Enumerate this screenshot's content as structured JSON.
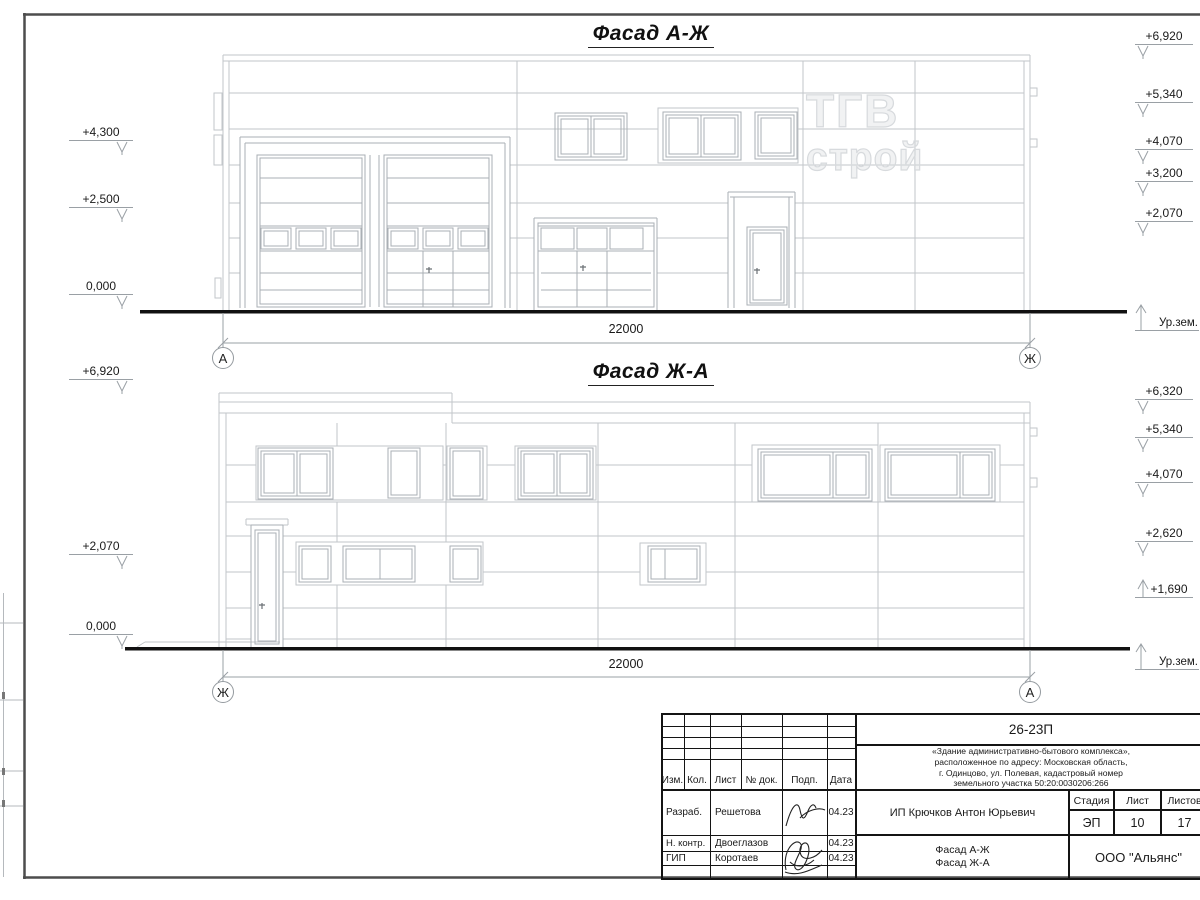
{
  "facade_top": {
    "title": "Фасад А-Ж",
    "dimension": "22000",
    "axis_left": "А",
    "axis_right": "Ж",
    "ground_label": "Ур.зем.",
    "marks_left": [
      "+4,300",
      "+2,500",
      "0,000"
    ],
    "marks_right": [
      "+6,920",
      "+5,340",
      "+4,070",
      "+3,200",
      "+2,070"
    ],
    "watermark": [
      "ТГВ",
      "строй"
    ]
  },
  "facade_bottom": {
    "title": "Фасад Ж-А",
    "dimension": "22000",
    "axis_left": "Ж",
    "axis_right": "А",
    "ground_label": "Ур.зем.",
    "marks_left": [
      "+6,920",
      "+2,070",
      "0,000"
    ],
    "marks_right": [
      "+6,320",
      "+5,340",
      "+4,070",
      "+2,620",
      "+1,690"
    ]
  },
  "title_block": {
    "doc_number": "26-23П",
    "description_lines": [
      "«Здание административно-бытового комплекса»,",
      "расположенное по адресу: Московская область,",
      "г. Одинцово, ул. Полевая, кадастровый номер",
      "земельного участка 50:20:0030206:266"
    ],
    "columns": [
      "Изм.",
      "Кол.",
      "Лист",
      "№ док.",
      "Подп.",
      "Дата"
    ],
    "signers": [
      {
        "role": "Разраб.",
        "name": "Решетова",
        "date": "04.23"
      },
      {
        "role": "Н. контр.",
        "name": "Двоеглазов",
        "date": "04.23"
      },
      {
        "role": "ГИП",
        "name": "Коротаев",
        "date": "04.23"
      }
    ],
    "client": "ИП Крючков Антон Юрьевич",
    "stage_label": "Стадия",
    "sheet_label": "Лист",
    "sheets_label": "Листов",
    "stage": "ЭП",
    "sheet_number": "10",
    "sheets_total": "17",
    "drawing_names": [
      "Фасад А-Ж",
      "Фасад Ж-А"
    ],
    "company": "ООО \"Альянс\"",
    "line_color": "#141414"
  },
  "drawing_colors": {
    "wall_lines": "#c2c6ca",
    "opening_lines": "#aaafb4",
    "dimension_lines": "#9aa0a5",
    "frame": "#4d4d4d"
  }
}
